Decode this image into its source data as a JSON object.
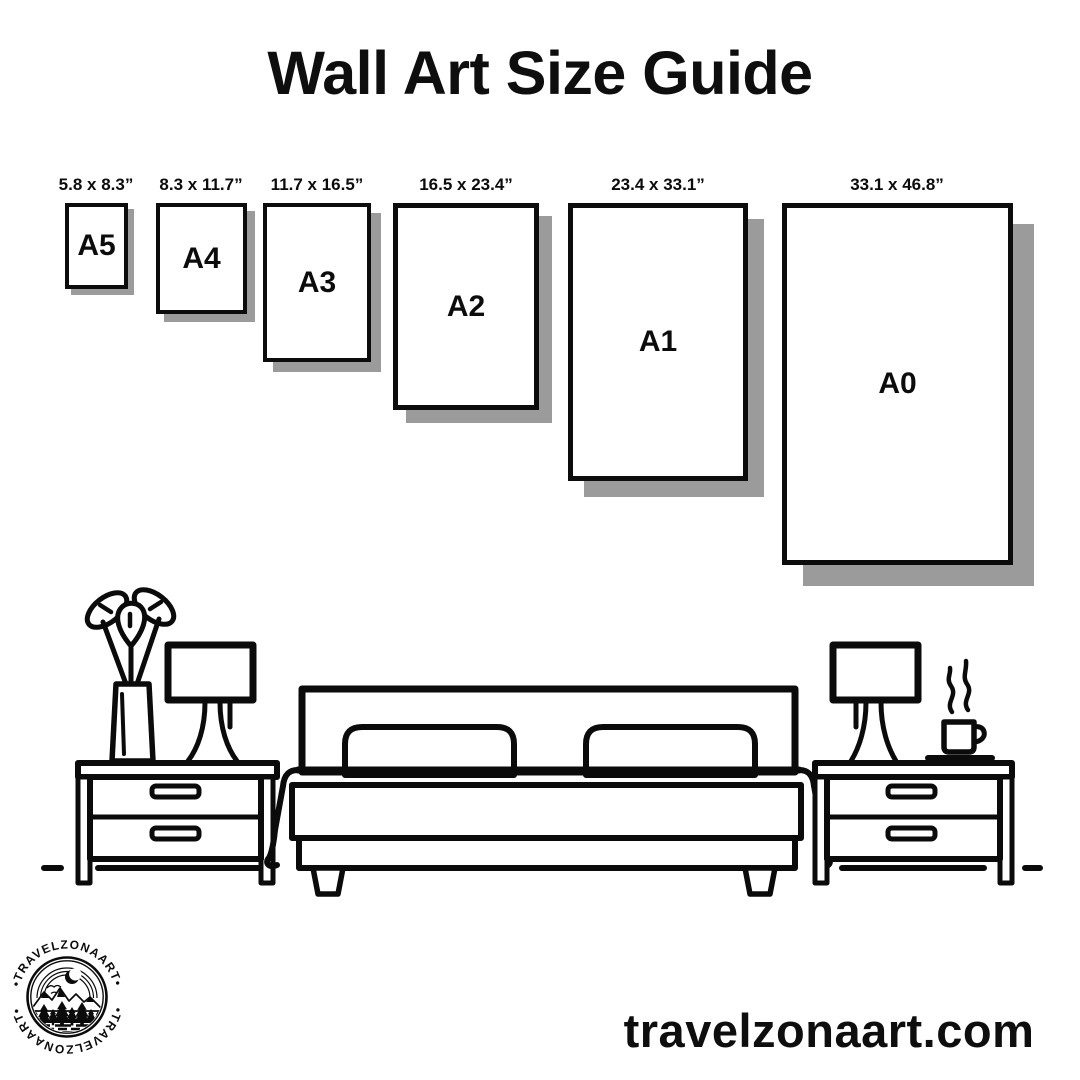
{
  "title": "Wall Art Size Guide",
  "sizes": [
    {
      "code": "A5",
      "dimensions": "5.8 x 8.3”"
    },
    {
      "code": "A4",
      "dimensions": "8.3 x 11.7”"
    },
    {
      "code": "A3",
      "dimensions": "11.7 x 16.5”"
    },
    {
      "code": "A2",
      "dimensions": "16.5 x 23.4”"
    },
    {
      "code": "A1",
      "dimensions": "23.4 x 33.1”"
    },
    {
      "code": "A0",
      "dimensions": "33.1 x 46.8”"
    }
  ],
  "logo": {
    "arc_text_top": "•TRAVELZONAART•",
    "arc_text_bottom": "•TRAVELZONAART•"
  },
  "footer": {
    "website": "travelzonaart.com"
  },
  "scene_icons": [
    "potted-plant",
    "table-lamp",
    "nightstand",
    "double-bed",
    "pillows",
    "coffee-cup",
    "steam"
  ],
  "colors": {
    "ink": "#0e0e0e",
    "line": "#0b0b0b",
    "shadow": "#9b9b9b",
    "background": "#ffffff"
  }
}
